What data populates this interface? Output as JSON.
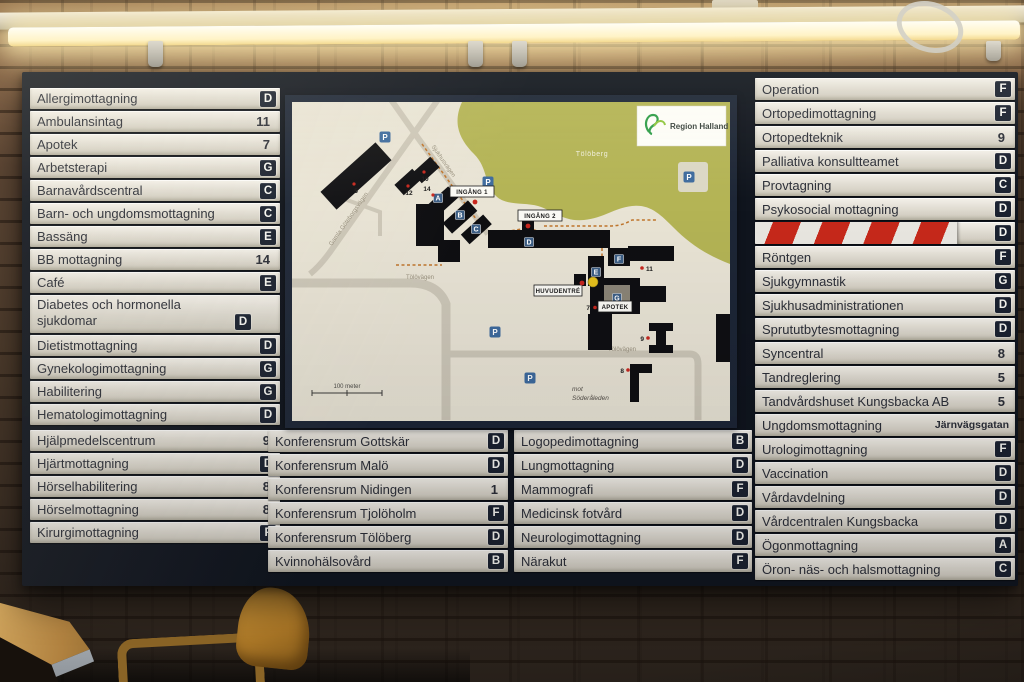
{
  "board": {
    "left_rows": [
      {
        "label": "Allergimottagning",
        "value": "D",
        "kind": "letter"
      },
      {
        "label": "Ambulansintag",
        "value": "11",
        "kind": "number"
      },
      {
        "label": "Apotek",
        "value": "7",
        "kind": "number"
      },
      {
        "label": "Arbetsterapi",
        "value": "G",
        "kind": "letter"
      },
      {
        "label": "Barnavårdscentral",
        "value": "C",
        "kind": "letter"
      },
      {
        "label": "Barn- och ungdomsmottagning",
        "value": "C",
        "kind": "letter"
      },
      {
        "label": "Bassäng",
        "value": "E",
        "kind": "letter"
      },
      {
        "label": "BB mottagning",
        "value": "14",
        "kind": "number"
      },
      {
        "label": "Café",
        "value": "E",
        "kind": "letter"
      },
      {
        "label": "Diabetes och hormonella sjukdomar",
        "value": "D",
        "kind": "letter",
        "tall": true
      },
      {
        "label": "Dietistmottagning",
        "value": "D",
        "kind": "letter"
      },
      {
        "label": "Gynekologimottagning",
        "value": "G",
        "kind": "letter"
      },
      {
        "label": "Habilitering",
        "value": "G",
        "kind": "letter"
      },
      {
        "label": "Hematologimottagning",
        "value": "D",
        "kind": "letter"
      },
      {
        "label": "Hjälpmedelscentrum",
        "value": "9",
        "kind": "number",
        "gap": true
      },
      {
        "label": "Hjärtmottagning",
        "value": "D",
        "kind": "letter"
      },
      {
        "label": "Hörselhabilitering",
        "value": "8",
        "kind": "number"
      },
      {
        "label": "Hörselmottagning",
        "value": "8",
        "kind": "number"
      },
      {
        "label": "Kirurgimottagning",
        "value": "F",
        "kind": "letter"
      }
    ],
    "center_left_rows": [
      {
        "label": "Konferensrum Gottskär",
        "value": "D",
        "kind": "letter"
      },
      {
        "label": "Konferensrum Malö",
        "value": "D",
        "kind": "letter"
      },
      {
        "label": "Konferensrum Nidingen",
        "value": "1",
        "kind": "number"
      },
      {
        "label": "Konferensrum Tjolöholm",
        "value": "F",
        "kind": "letter"
      },
      {
        "label": "Konferensrum Tölöberg",
        "value": "D",
        "kind": "letter"
      },
      {
        "label": "Kvinnohälsovård",
        "value": "B",
        "kind": "letter"
      }
    ],
    "center_right_rows": [
      {
        "label": "Logopedimottagning",
        "value": "B",
        "kind": "letter"
      },
      {
        "label": "Lungmottagning",
        "value": "D",
        "kind": "letter"
      },
      {
        "label": "Mammografi",
        "value": "F",
        "kind": "letter"
      },
      {
        "label": "Medicinsk fotvård",
        "value": "D",
        "kind": "letter"
      },
      {
        "label": "Neurologimottagning",
        "value": "D",
        "kind": "letter"
      },
      {
        "label": "Närakut",
        "value": "F",
        "kind": "letter"
      }
    ],
    "right_rows": [
      {
        "label": "Operation",
        "value": "F",
        "kind": "letter"
      },
      {
        "label": "Ortopedimottagning",
        "value": "F",
        "kind": "letter"
      },
      {
        "label": "Ortopedteknik",
        "value": "9",
        "kind": "number"
      },
      {
        "label": "Palliativa konsultteamet",
        "value": "D",
        "kind": "letter"
      },
      {
        "label": "Provtagning",
        "value": "C",
        "kind": "letter"
      },
      {
        "label": "Psykosocial mottagning",
        "value": "D",
        "kind": "letter"
      },
      {
        "label": "",
        "value": "D",
        "kind": "letter",
        "taped": true
      },
      {
        "label": "Röntgen",
        "value": "F",
        "kind": "letter"
      },
      {
        "label": "Sjukgymnastik",
        "value": "G",
        "kind": "letter"
      },
      {
        "label": "Sjukhusadministrationen",
        "value": "D",
        "kind": "letter"
      },
      {
        "label": "Sprututbytesmottagning",
        "value": "D",
        "kind": "letter"
      },
      {
        "label": "Syncentral",
        "value": "8",
        "kind": "number"
      },
      {
        "label": "Tandreglering",
        "value": "5",
        "kind": "number"
      },
      {
        "label": "Tandvårdshuset Kungsbacka AB",
        "value": "5",
        "kind": "number"
      },
      {
        "label": "Ungdomsmottagning",
        "value": "Järnvägsgatan",
        "kind": "text"
      },
      {
        "label": "Urologimottagning",
        "value": "F",
        "kind": "letter"
      },
      {
        "label": "Vaccination",
        "value": "D",
        "kind": "letter"
      },
      {
        "label": "Vårdavdelning",
        "value": "D",
        "kind": "letter"
      },
      {
        "label": "Vårdcentralen Kungsbacka",
        "value": "D",
        "kind": "letter"
      },
      {
        "label": "Ögonmottagning",
        "value": "A",
        "kind": "letter"
      },
      {
        "label": "Öron- näs- och halsmottagning",
        "value": "C",
        "kind": "letter"
      }
    ]
  },
  "map": {
    "logo": "Region Halland",
    "hill": "Tölöberg",
    "scale": "100 meter",
    "entrance1": "INGÅNG 1",
    "entrance2": "INGÅNG 2",
    "main_entrance": "HUVUDENTRÉ",
    "pharmacy": "APOTEK",
    "direction_line1": "mot",
    "direction_line2": "Söderåleden",
    "roads": {
      "nw": "Gamla Göteborgsvägen",
      "ne": "Sjukhusvägen",
      "w": "Tölövägen",
      "s": "Tölövägen"
    },
    "parking": "P",
    "letters": {
      "a": "A",
      "b": "B",
      "c": "C",
      "d": "D",
      "e": "E",
      "f": "F",
      "g": "G"
    },
    "nums": {
      "n5": "5",
      "n7": "7",
      "n8": "8",
      "n9": "9",
      "n10": "10",
      "n11": "11",
      "n12": "12",
      "n14": "14"
    }
  },
  "colors": {
    "badge_navy": "#1b2230",
    "strip_beige": "#e3dfd5",
    "board_frame": "#10151e",
    "map_green": "#b4b455",
    "hazard_red": "#c7291b",
    "parking_blue": "#3e6b9e",
    "entrance_red": "#c8271e"
  }
}
